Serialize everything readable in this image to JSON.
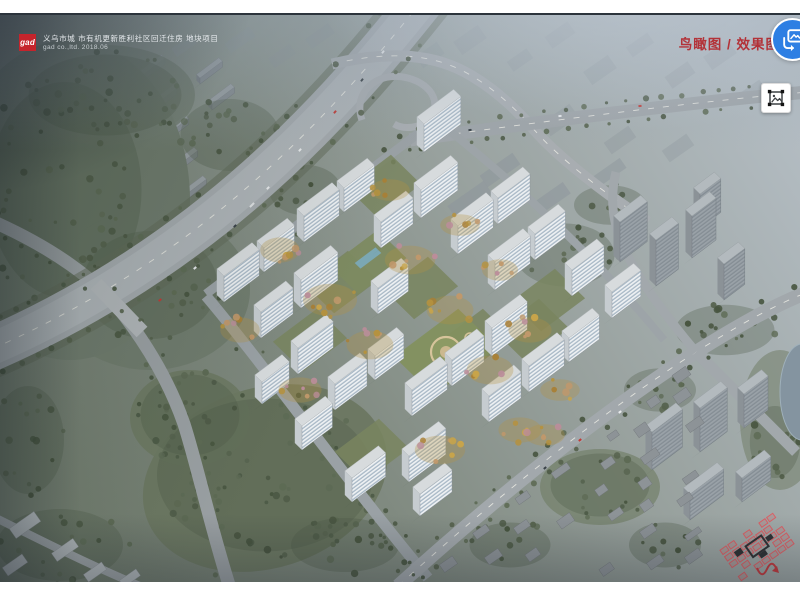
{
  "header": {
    "logo_text": "gad",
    "logo_bg": "#c5242c",
    "project_title": "义乌市城 市有机更新胜利社区回迁住房 地块项目",
    "project_subtitle": "gad co.,ltd. 2018.06"
  },
  "view_label": {
    "text": "鸟瞰图 / 效果图",
    "color": "#b33238"
  },
  "buttons": {
    "translate_bg": "#2e7fe3",
    "image_icon_color": "#3c4043"
  },
  "scene": {
    "tree_palette": [
      "#4d5a46",
      "#55624d",
      "#5d6a54",
      "#47543f"
    ],
    "autumn_palette": [
      "#b5923f",
      "#c8a44a",
      "#a97f35",
      "#c0986b",
      "#bb8d9a"
    ],
    "white_palette": {
      "fac": "url(#pw)",
      "edge": "#8a939b",
      "roof": "#d7dbdd",
      "roofEdge": "#b7bcbf",
      "end": "#c6ccd0"
    },
    "gray_palette": {
      "fac": "url(#pg)",
      "edge": "#6f777d",
      "roof": "#b3babe",
      "roofEdge": "#9aa1a5",
      "end": "#8b9297"
    },
    "towers": [
      [
        224,
        302,
        44,
        26
      ],
      [
        264,
        272,
        38,
        24
      ],
      [
        304,
        242,
        44,
        26
      ],
      [
        344,
        212,
        38,
        24
      ],
      [
        424,
        152,
        46,
        28
      ],
      [
        261,
        338,
        40,
        26
      ],
      [
        301,
        308,
        46,
        28
      ],
      [
        381,
        248,
        40,
        26
      ],
      [
        421,
        218,
        46,
        28
      ],
      [
        298,
        374,
        44,
        26
      ],
      [
        378,
        314,
        38,
        26
      ],
      [
        458,
        254,
        44,
        28
      ],
      [
        498,
        224,
        40,
        26
      ],
      [
        335,
        410,
        40,
        26
      ],
      [
        375,
        380,
        36,
        24
      ],
      [
        495,
        290,
        44,
        28
      ],
      [
        535,
        260,
        38,
        26
      ],
      [
        412,
        416,
        44,
        26
      ],
      [
        452,
        386,
        40,
        26
      ],
      [
        492,
        356,
        44,
        28
      ],
      [
        572,
        296,
        40,
        26
      ],
      [
        409,
        482,
        46,
        26
      ],
      [
        489,
        422,
        40,
        26
      ],
      [
        529,
        392,
        44,
        26
      ],
      [
        569,
        362,
        38,
        24
      ],
      [
        262,
        404,
        34,
        22
      ],
      [
        302,
        450,
        38,
        24
      ],
      [
        352,
        502,
        42,
        24
      ],
      [
        420,
        516,
        40,
        22
      ],
      [
        612,
        318,
        36,
        26
      ]
    ],
    "gray_towers": [
      [
        620,
        262,
        34,
        40
      ],
      [
        656,
        286,
        28,
        46
      ],
      [
        692,
        258,
        30,
        42
      ],
      [
        724,
        300,
        26,
        36
      ],
      [
        700,
        228,
        26,
        34
      ],
      [
        652,
        470,
        38,
        38
      ],
      [
        700,
        452,
        34,
        44
      ],
      [
        744,
        428,
        30,
        34
      ],
      [
        690,
        520,
        42,
        26
      ],
      [
        742,
        502,
        36,
        24
      ]
    ],
    "warehouses": [
      [
        128,
        92,
        46
      ],
      [
        140,
        122,
        46
      ],
      [
        152,
        152,
        46
      ],
      [
        164,
        182,
        42
      ],
      [
        176,
        208,
        38
      ],
      [
        200,
        84,
        28
      ],
      [
        212,
        110,
        28
      ]
    ],
    "distant_blocks": [
      [
        430,
        55,
        26,
        14,
        0.3
      ],
      [
        470,
        40,
        30,
        16,
        0.28
      ],
      [
        520,
        60,
        24,
        12,
        0.3
      ],
      [
        560,
        35,
        28,
        14,
        0.25
      ],
      [
        600,
        70,
        30,
        16,
        0.3
      ],
      [
        640,
        45,
        26,
        12,
        0.25
      ],
      [
        680,
        75,
        28,
        14,
        0.28
      ],
      [
        720,
        55,
        30,
        16,
        0.25
      ],
      [
        752,
        92,
        26,
        12,
        0.28
      ],
      [
        560,
        120,
        34,
        16,
        0.35
      ],
      [
        620,
        140,
        30,
        14,
        0.35
      ],
      [
        678,
        148,
        30,
        14,
        0.32
      ],
      [
        240,
        40,
        30,
        12,
        0.3
      ],
      [
        282,
        56,
        26,
        12,
        0.28
      ],
      [
        320,
        36,
        28,
        12,
        0.25
      ],
      [
        184,
        46,
        24,
        10,
        0.3
      ],
      [
        500,
        170,
        40,
        14,
        0.5
      ],
      [
        552,
        198,
        36,
        14,
        0.5
      ],
      [
        610,
        172,
        32,
        12,
        0.45
      ],
      [
        470,
        200,
        44,
        16,
        0.5
      ]
    ],
    "park_masses": [
      [
        70,
        200,
        120,
        160,
        0,
        "#6f7b6d",
        1
      ],
      [
        150,
        290,
        100,
        80,
        0,
        "#6f7b6d",
        0.9
      ],
      [
        265,
        478,
        125,
        90,
        -18,
        "#6b7761",
        0.95
      ],
      [
        190,
        418,
        60,
        48,
        0,
        "#6d7963",
        0.9
      ],
      [
        105,
        95,
        90,
        50,
        0,
        "#717d6f",
        0.85
      ],
      [
        600,
        487,
        60,
        38,
        0,
        "#74806a",
        0.7
      ],
      [
        780,
        420,
        40,
        70,
        0,
        "#76826e",
        0.6
      ]
    ],
    "forest_clusters": [
      [
        65,
        190,
        85,
        120,
        55
      ],
      [
        150,
        285,
        75,
        60,
        35
      ],
      [
        105,
        95,
        85,
        45,
        28
      ],
      [
        230,
        135,
        55,
        40,
        20
      ],
      [
        305,
        190,
        40,
        28,
        13
      ],
      [
        265,
        475,
        120,
        85,
        58
      ],
      [
        190,
        415,
        55,
        45,
        20
      ],
      [
        345,
        545,
        60,
        30,
        16
      ],
      [
        60,
        545,
        70,
        40,
        18
      ],
      [
        28,
        440,
        40,
        60,
        16
      ],
      [
        565,
        255,
        55,
        35,
        18
      ],
      [
        610,
        205,
        40,
        22,
        10
      ],
      [
        725,
        330,
        55,
        28,
        16
      ],
      [
        775,
        442,
        28,
        40,
        14
      ],
      [
        660,
        390,
        40,
        24,
        10
      ],
      [
        600,
        485,
        55,
        35,
        14
      ],
      [
        510,
        545,
        45,
        25,
        10
      ],
      [
        665,
        545,
        40,
        25,
        9
      ]
    ],
    "autumn_clusters": [
      [
        330,
        300,
        30,
        18,
        8
      ],
      [
        410,
        260,
        28,
        16,
        7
      ],
      [
        370,
        345,
        26,
        16,
        7
      ],
      [
        450,
        310,
        26,
        16,
        7
      ],
      [
        490,
        370,
        26,
        16,
        7
      ],
      [
        530,
        330,
        24,
        14,
        6
      ],
      [
        440,
        450,
        28,
        16,
        7
      ],
      [
        520,
        430,
        24,
        14,
        6
      ],
      [
        560,
        390,
        22,
        12,
        5
      ],
      [
        300,
        390,
        24,
        14,
        6
      ],
      [
        390,
        190,
        22,
        12,
        5
      ],
      [
        460,
        225,
        22,
        12,
        5
      ],
      [
        240,
        330,
        22,
        14,
        6
      ],
      [
        280,
        250,
        22,
        14,
        6
      ],
      [
        500,
        270,
        20,
        12,
        5
      ],
      [
        545,
        435,
        22,
        12,
        5
      ]
    ],
    "roads": [
      {
        "d": "M-15,218 C55,248 98,282 120,310 C142,338 168,378 184,424 C198,468 210,525 230,588",
        "w": 13,
        "c": "#9aa0a3",
        "trees": true
      },
      {
        "d": "M432,-12 C340,105 210,255 -15,352",
        "w": 44,
        "c": "#a4aaae",
        "verge": true,
        "dash": true,
        "trees": true,
        "inner": true
      },
      {
        "d": "M96,284 L142,332",
        "w": 15,
        "c": "#b2b7ba"
      },
      {
        "d": "M332,64 C392,50 436,54 472,76 C502,94 522,116 538,134 C560,158 600,190 648,222",
        "w": 11,
        "c": "#a8adb1",
        "dash": true
      },
      {
        "d": "M362,120 C352,92 378,70 408,78 C434,85 442,106 428,120 C420,128 404,130 394,124",
        "w": 7,
        "c": "#a8adb1"
      },
      {
        "d": "M410,140 C540,122 690,102 808,92",
        "w": 13,
        "c": "#9fa5a9",
        "dash": true,
        "trees": true
      },
      {
        "d": "M206,294 L436,120",
        "w": 9,
        "c": "#9aa1a5",
        "trees": true
      },
      {
        "d": "M206,296 C262,362 340,472 428,578",
        "w": 11,
        "c": "#9aa1a5",
        "trees": true
      },
      {
        "d": "M398,586 C500,494 600,414 696,352 C734,328 772,306 808,292",
        "w": 14,
        "c": "#a2a8ac",
        "dash": true,
        "trees": true
      },
      {
        "d": "M696,352 C726,382 762,418 796,452",
        "w": 11,
        "c": "#a2a8ac"
      },
      {
        "d": "M696,352 C664,314 636,276 622,244 C612,220 610,196 616,172",
        "w": 9,
        "c": "#a2a8ac"
      },
      {
        "d": "M436,120 C520,186 600,262 664,340",
        "w": 8,
        "c": "#9da4a8"
      },
      {
        "d": "M-10,515 C40,540 90,565 140,586",
        "w": 8,
        "c": "#9fa5a8"
      }
    ],
    "courtyards": [
      [
        341,
        282
      ],
      [
        421,
        288
      ],
      [
        384,
        186
      ],
      [
        532,
        330
      ],
      [
        372,
        450
      ],
      [
        476,
        340
      ],
      [
        548,
        300
      ],
      [
        310,
        340
      ]
    ],
    "garden_center": [
      446,
      352
    ],
    "pool_garden": [
      368,
      262
    ],
    "bl_boxes": [
      [
        25,
        525,
        30,
        12
      ],
      [
        65,
        550,
        26,
        10
      ],
      [
        15,
        565,
        24,
        10
      ],
      [
        95,
        572,
        22,
        9
      ],
      [
        130,
        578,
        20,
        8
      ]
    ],
    "pond": [
      802,
      392,
      22,
      48
    ],
    "cars": [
      [
        383,
        52,
        -52,
        "#e8eaec",
        3.4
      ],
      [
        362,
        80,
        -52,
        "#3a4248",
        3.4
      ],
      [
        335,
        112,
        -50,
        "#c23a35",
        3.4
      ],
      [
        300,
        150,
        -48,
        "#e8eaec",
        3.4
      ],
      [
        268,
        188,
        -46,
        "#e8eaec",
        3.4
      ],
      [
        252,
        205,
        -45,
        "#dde0e2",
        6
      ],
      [
        235,
        226,
        -44,
        "#3a4248",
        3.4
      ],
      [
        195,
        268,
        -42,
        "#e8eaec",
        3.4
      ],
      [
        160,
        300,
        -40,
        "#c23a35",
        3.4
      ],
      [
        580,
        440,
        -38,
        "#c23a35",
        3.2
      ],
      [
        620,
        412,
        -35,
        "#e8eaec",
        3.2
      ],
      [
        545,
        468,
        -38,
        "#3a4248",
        3.2
      ],
      [
        560,
        116,
        -6,
        "#e8eaec",
        3.2
      ],
      [
        640,
        106,
        -6,
        "#c23a35",
        3.2
      ],
      [
        470,
        130,
        -8,
        "#3a4248",
        3.2
      ]
    ],
    "miniplan": {
      "x": 757,
      "y": 547,
      "rot": -35,
      "cell": "#e05a60",
      "dark": "#232629",
      "arrow": "#c23a3f"
    }
  }
}
